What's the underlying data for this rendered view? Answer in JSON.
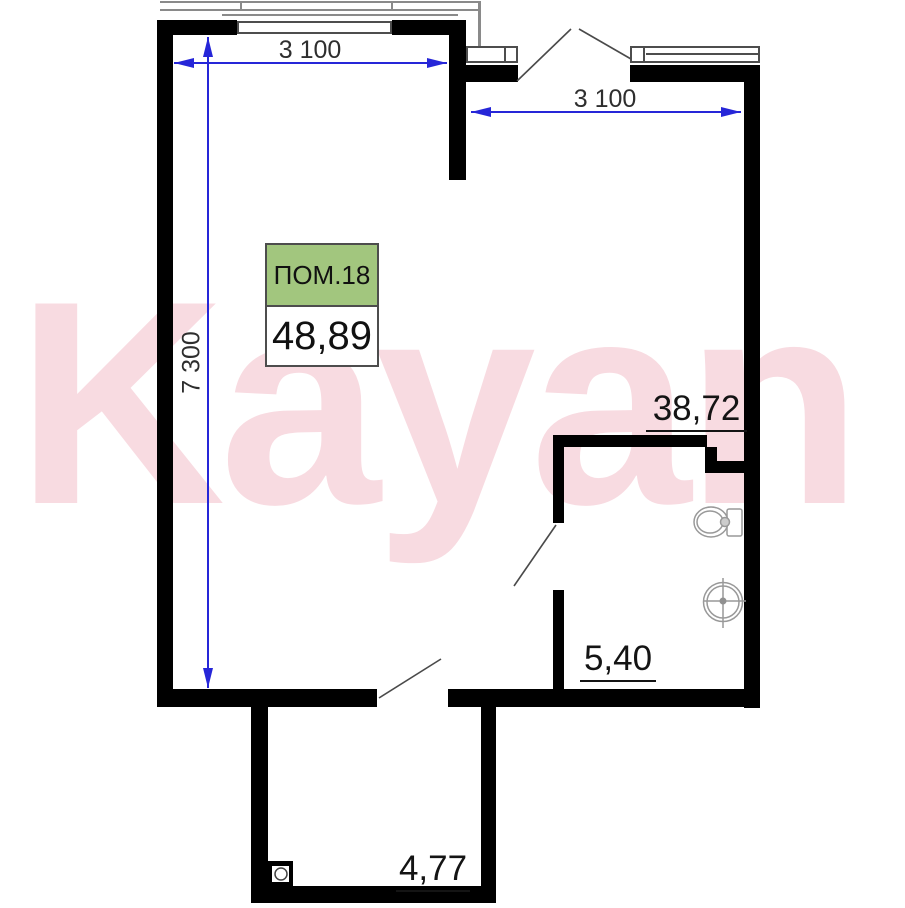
{
  "watermark": {
    "text": "Kayan",
    "color": "#f8dbe1"
  },
  "room_label_box": {
    "name": "ПОМ.18",
    "total_area": "48,89",
    "header_color": "#a2c67e"
  },
  "areas": {
    "main_room": "38,72",
    "bathroom": "5,40",
    "balcony": "4,77"
  },
  "dimensions": {
    "top_left_width": "3 100",
    "top_right_width": "3 100",
    "left_height": "7 300",
    "line_color": "#2626d8"
  },
  "colors": {
    "wall": "#000000",
    "glazing_line": "#8a8a8a",
    "fixture_stroke": "#999999",
    "door_line": "#4a4a4a",
    "area_text": "#141414"
  }
}
